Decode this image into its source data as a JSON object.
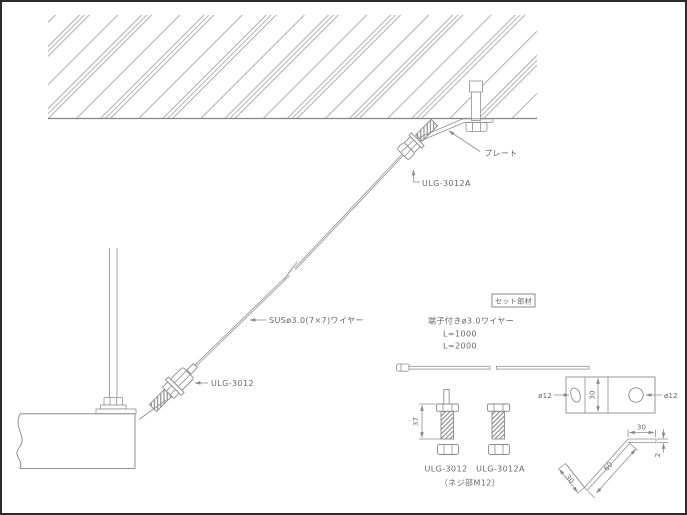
{
  "installation_view": {
    "plate_label": "プレート",
    "upper_fitting_label": "ULG-3012A",
    "wire_label": "SUSø3.0(7×7)ワイヤー",
    "lower_fitting_label": "ULG-3012"
  },
  "set_parts": {
    "box_title": "セット部材",
    "wire_item": {
      "title": "端子付きø3.0ワイヤー",
      "lengths": [
        "L=1000",
        "L=2000"
      ]
    },
    "bolts": {
      "left_label": "ULG-3012",
      "right_label": "ULG-3012A",
      "note": "（ネジ部M12）",
      "length_dim": "37"
    },
    "plate": {
      "hole_left_dim": "ø12",
      "hole_right_dim": "ø12",
      "width_dim": "30"
    },
    "angle": {
      "top_leg_dim": "30",
      "thickness_dim": "2",
      "web_dim": "60",
      "bottom_leg_dim": "30"
    }
  },
  "colors": {
    "line": "#8f8f8f",
    "text": "#686868",
    "border": "#2b2b2b"
  }
}
